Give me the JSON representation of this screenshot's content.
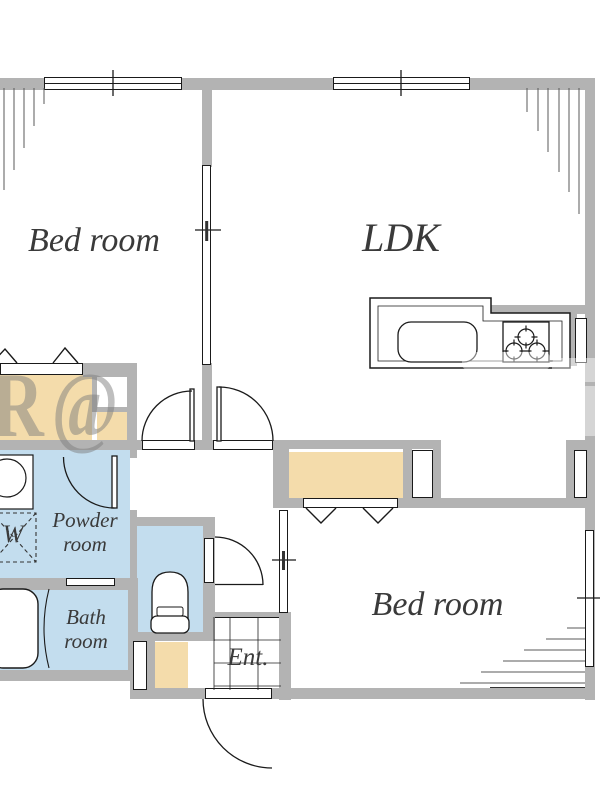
{
  "plan": {
    "type": "apartment-floor-plan",
    "rooms": {
      "bedroom_top": "Bed room",
      "ldk": "LDK",
      "bedroom_bottom": "Bed room",
      "powder_line1": "Powder",
      "powder_line2": "room",
      "bath_line1": "Bath",
      "bath_line2": "room",
      "entrance": "Ent.",
      "washing_machine": "W"
    },
    "watermark": "R@",
    "colors": {
      "wall": "#b3b3b3",
      "closet_fill": "#f4dcab",
      "wet_area_fill": "#c3ddee",
      "line": "#1a1a1a",
      "label_text": "#3a3a3a"
    }
  }
}
